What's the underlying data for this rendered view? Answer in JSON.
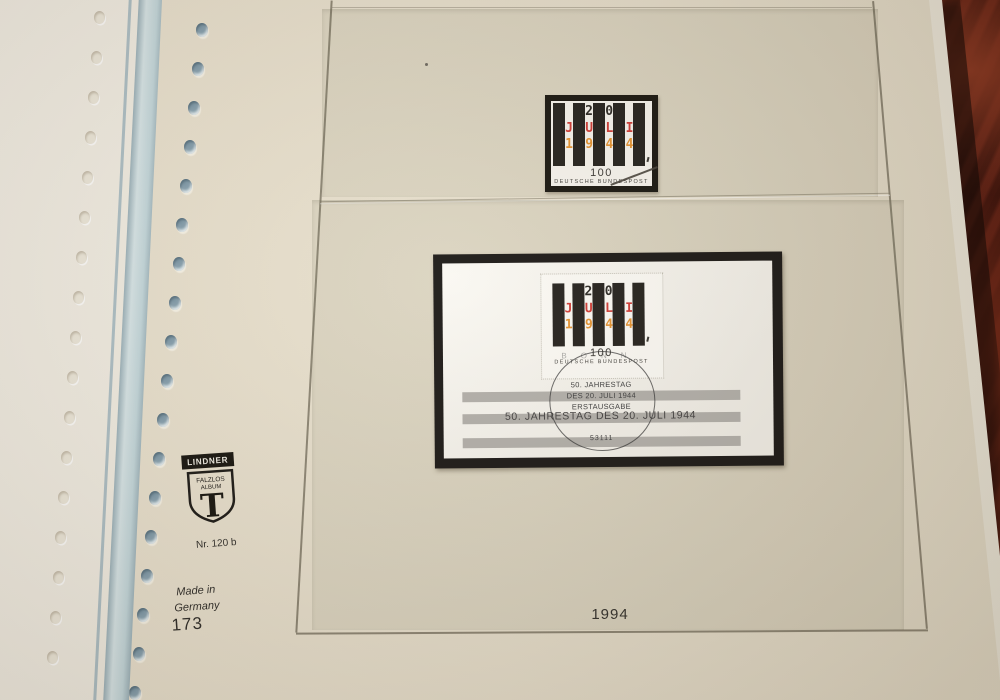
{
  "page": {
    "year_caption": "1994",
    "page_number": "173",
    "ref_number": "Nr. 120 b",
    "made_in": [
      "Made in",
      "Germany"
    ],
    "brand": {
      "name": "LINDNER",
      "shield_line1": "FALZLOS",
      "shield_line2": "ALBUM",
      "shield_monogram": "T"
    }
  },
  "stamp": {
    "day": "20",
    "month": "JULI",
    "year": "1944",
    "value": "100",
    "country": "DEUTSCHE BUNDESPOST",
    "colors": {
      "bar": "#24211c",
      "day_text": "#2a2722",
      "month_text": "#cf3b34",
      "year_text": "#e5922f"
    }
  },
  "souvenir_sheet": {
    "title": "50. JAHRESTAG DES 20. JULI 1944",
    "postmark": {
      "city": "BONN",
      "line1": "50. JAHRESTAG",
      "line2": "DES 20. JULI 1944",
      "line3": "ERSTAUSGABE",
      "postal_code": "53111"
    }
  }
}
